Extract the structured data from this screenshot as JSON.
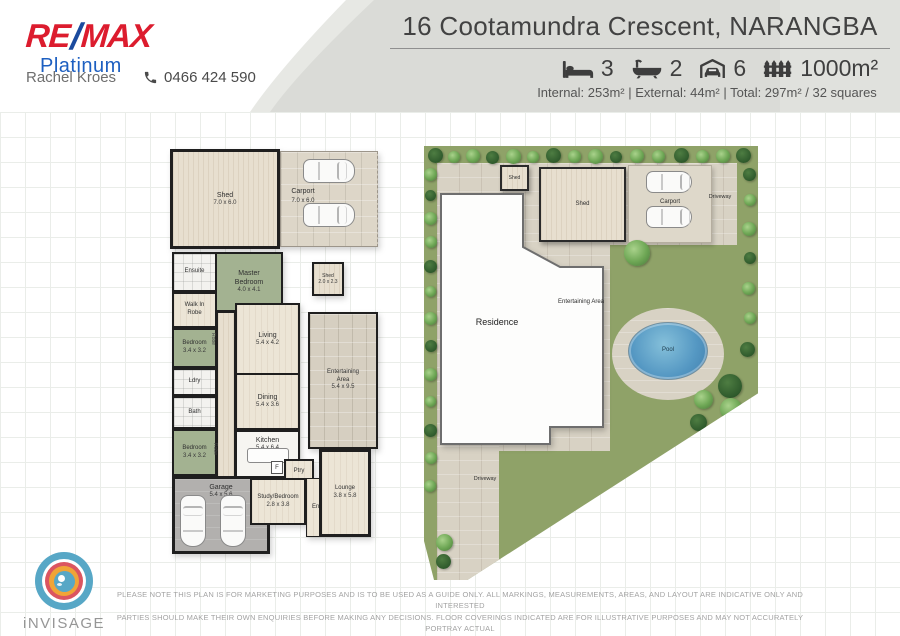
{
  "header": {
    "brand": {
      "re": "RE",
      "slash": "/",
      "max": "MAX",
      "sub": "Platinum"
    },
    "agent": "Rachel Kroes",
    "phone": "0466 424 590",
    "title": "16 Cootamundra Crescent, NARANGBA",
    "features": [
      {
        "icon": "bed-icon",
        "value": "3"
      },
      {
        "icon": "bath-icon",
        "value": "2"
      },
      {
        "icon": "car-garage-icon",
        "value": "6"
      },
      {
        "icon": "fence-icon",
        "value": "1000m²"
      }
    ],
    "stats": "Internal: 253m²  |  External: 44m²  |  Total:  297m² / 32 squares"
  },
  "floorplan": {
    "rooms": {
      "shed_big": {
        "name": "Shed",
        "dims": "7.0 x 6.0"
      },
      "carport": {
        "name": "Carport",
        "dims": "7.0 x 6.0"
      },
      "shed_small": {
        "name": "Shed",
        "dims": "2.0 x 2.3"
      },
      "ensuite": {
        "name": "Ensuite"
      },
      "master": {
        "name": "Master Bedroom",
        "dims": "4.0 x 4.1"
      },
      "wir": {
        "name": "Walk In Robe"
      },
      "bed1": {
        "name": "Bedroom",
        "dims": "3.4 x 3.2"
      },
      "ldry": {
        "name": "Ldry"
      },
      "bath": {
        "name": "Bath"
      },
      "bed2": {
        "name": "Bedroom",
        "dims": "3.4 x 3.2"
      },
      "robe": "Robe",
      "garage": {
        "name": "Garage",
        "dims": "5.4 x 5.6"
      },
      "living": {
        "name": "Living",
        "dims": "5.4 x 4.2"
      },
      "dining": {
        "name": "Dining",
        "dims": "5.4 x 3.6"
      },
      "kitchen": {
        "name": "Kitchen",
        "dims": "5.4 x 6.4"
      },
      "fridge": "F",
      "pantry": "Ptry",
      "study": {
        "name": "Study/Bedroom",
        "dims": "2.8 x 3.8"
      },
      "entry": "Entry",
      "lounge": {
        "name": "Lounge",
        "dims": "3.8 x 5.8"
      },
      "entertaining": {
        "name": "Entertaining Area",
        "dims": "5.4 x 9.5"
      }
    }
  },
  "siteplan": {
    "labels": {
      "shed_small": "Shed",
      "shed_large": "Shed",
      "carport": "Carport",
      "driveway_top": "Driveway",
      "residence": "Residence",
      "entertaining": "Entertaining Area",
      "pool": "Pool",
      "driveway_bottom": "Driveway"
    }
  },
  "footer": {
    "logo_text": "iNVISAGE",
    "disclaimer": [
      "PLEASE NOTE THIS PLAN IS FOR MARKETING PURPOSES AND IS TO BE USED AS A GUIDE ONLY.  ALL MARKINGS, MEASUREMENTS, AREAS, AND LAYOUT ARE INDICATIVE ONLY AND INTERESTED",
      "PARTIES SHOULD MAKE THEIR OWN ENQUIRIES BEFORE MAKING ANY DECISIONS.  FLOOR COVERINGS INDICATED ARE FOR ILLUSTRATIVE PURPOSES AND MAY NOT ACCURATELY PORTRAY ACTUAL",
      "FLOOR COVERINGS OF THE PROPERTY.  INVISAGE MEDIA PTY LTD MAKES NO GUARANTEES REGARDING THE INFORMATION CONTAINED IN THIS PLAN AND ACCEPTS NO LIABILITY FOR ANY INACCURACIES."
    ]
  },
  "colors": {
    "remax_red": "#DC1C2E",
    "remax_blue": "#1A4A9E",
    "platinum_blue": "#1D5FC1",
    "bedroom_green": "#A3B291",
    "lawn_green": "#8FA268",
    "pool_blue": "#5598C3",
    "paving": "#D8D2C4"
  }
}
